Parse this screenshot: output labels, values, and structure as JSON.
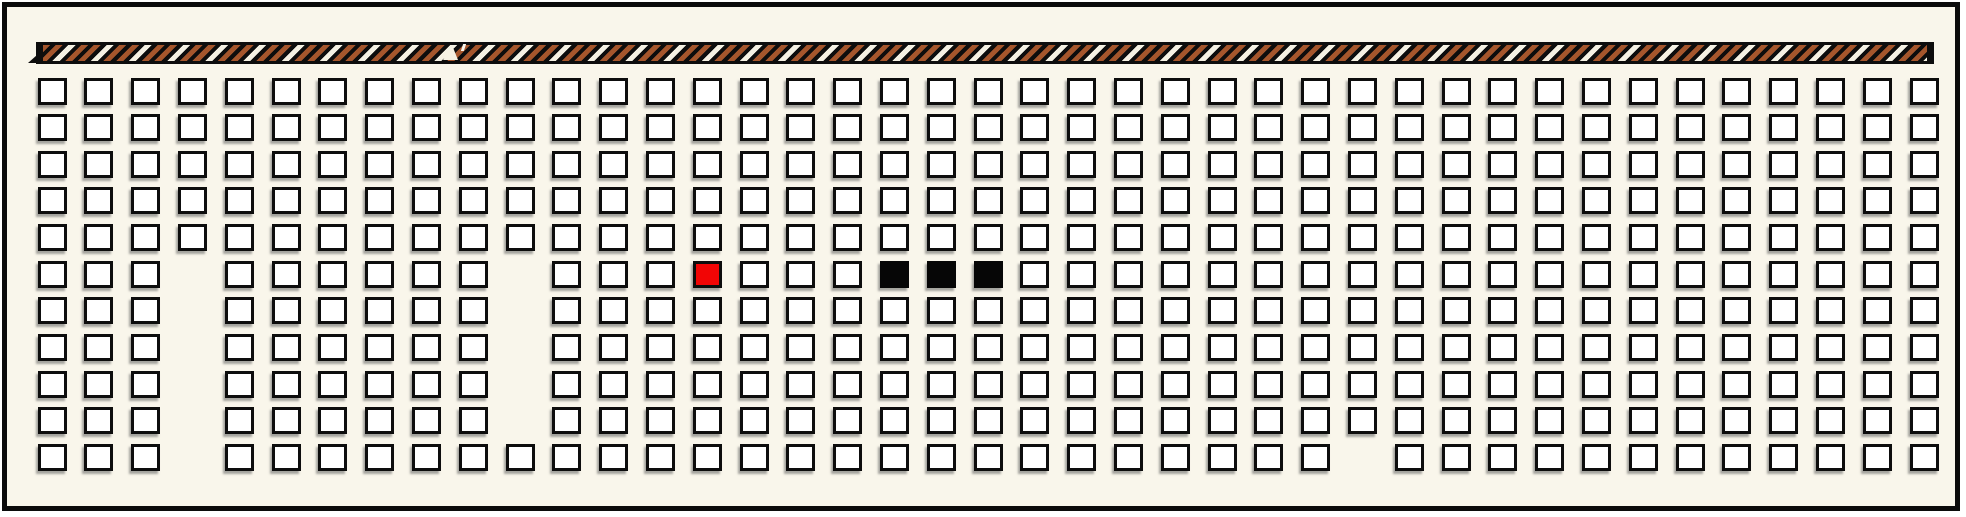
{
  "window": {
    "kind": "seat-map",
    "background_color": "#f9f6eb",
    "frame_border_color": "#0b0b0b"
  },
  "stage_bar": {
    "bar_color": "#0d0d0d",
    "stripe_brown": "#a5562c",
    "stripe_white": "#f5f1e3",
    "stripe_direction": "diagonal-forward-slash"
  },
  "grid": {
    "rows": 11,
    "cols": 41,
    "seat_fill": "#ffffff",
    "seat_border": "#0d0d0d",
    "selected_color": "#f20505",
    "occupied_color": "#060606",
    "selected_seats": [
      {
        "row": 6,
        "col": 15
      }
    ],
    "occupied_seats": [
      {
        "row": 6,
        "col": 19
      },
      {
        "row": 6,
        "col": 20
      },
      {
        "row": 6,
        "col": 21
      }
    ],
    "missing_seats": [
      {
        "row": 6,
        "col": 4
      },
      {
        "row": 7,
        "col": 4
      },
      {
        "row": 8,
        "col": 4
      },
      {
        "row": 9,
        "col": 4
      },
      {
        "row": 10,
        "col": 4
      },
      {
        "row": 11,
        "col": 4
      },
      {
        "row": 6,
        "col": 11
      },
      {
        "row": 7,
        "col": 11
      },
      {
        "row": 8,
        "col": 11
      },
      {
        "row": 9,
        "col": 11
      },
      {
        "row": 10,
        "col": 11
      },
      {
        "row": 11,
        "col": 29
      }
    ]
  }
}
